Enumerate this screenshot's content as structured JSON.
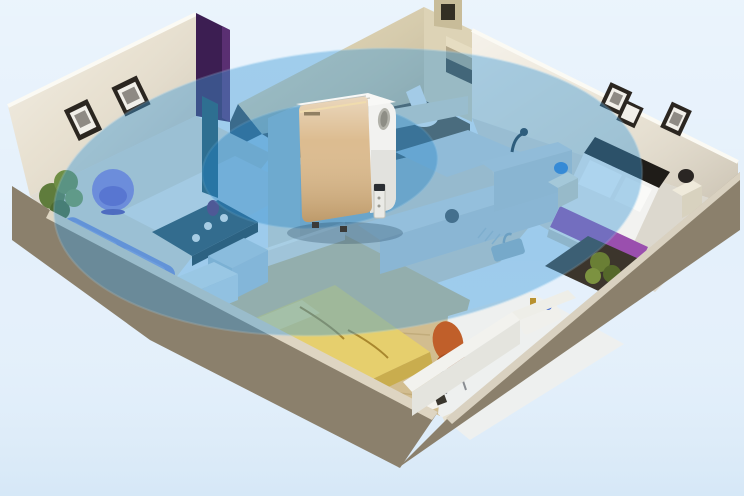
{
  "scene": {
    "device": "air-purifier",
    "coverage": [
      "coverage-inner-ring",
      "coverage-outer-ring"
    ],
    "rooms": [
      "living-room",
      "hallway-kitchen",
      "bathroom",
      "master-bedroom",
      "second-bedroom",
      "study-nook"
    ]
  },
  "colors": {
    "background": "#e4f0fb",
    "coverage_outer": "#3e9ad8",
    "coverage_inner": "#1e82c8",
    "purifier_gold": "#d9b686",
    "purifier_gold_light": "#f0dcae",
    "purifier_white": "#f2f2f0",
    "exterior_wall": "#8b806c",
    "left_wall": "#e5ddcb",
    "right_wall": "#e9e2d2",
    "bathroom_wall": "#d3c7a4",
    "wardrobe_purple": "#3c1e52",
    "sofa_blue": "#7d8ed8",
    "chair_purple": "#8f84de",
    "table_teal": "#2c4c58",
    "bed_yellow": "#e6cf6d",
    "chair_orange": "#c05f2a",
    "bed_white": "#f2f2f0",
    "runner_purple": "#9a4fae",
    "floor_main": "#e0dcd2",
    "floor_wood": "#d2bd8f",
    "floor_study": "#eef0ef",
    "rug_dark": "#3c352c",
    "plant_green": "#5f7c3c"
  }
}
